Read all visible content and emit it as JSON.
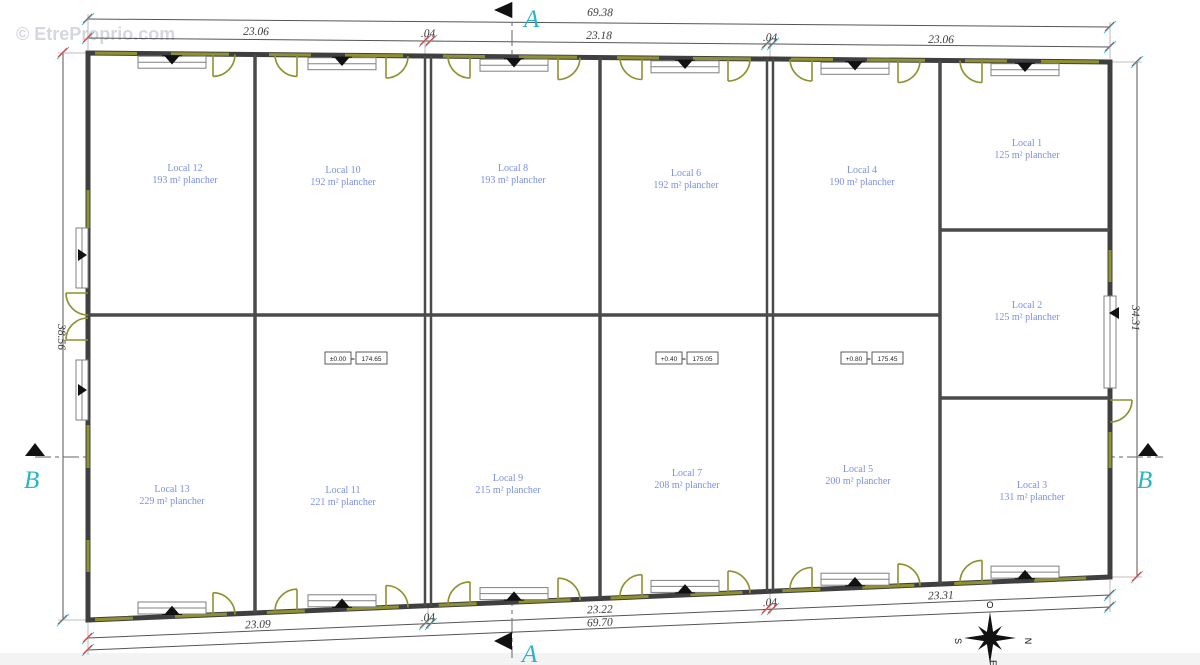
{
  "watermark": "© EtreProprio.com",
  "markers": {
    "a": "A",
    "b": "B"
  },
  "equals_sign": "=",
  "compass": {
    "n": "N",
    "s": "S",
    "e": "E",
    "o": "O"
  },
  "dimensions": {
    "top_total": "69.38",
    "top_seg1": "23.06",
    "top_gap1": ".04",
    "top_seg2": "23.18",
    "top_gap2": ".04",
    "top_seg3": "23.06",
    "bottom_total": "69.70",
    "bottom_seg1": "23.09",
    "bottom_gap1": ".04",
    "bottom_seg2": "23.22",
    "bottom_gap2": ".04",
    "bottom_seg3": "23.31",
    "left": "38.56",
    "right": "34.31"
  },
  "levels": [
    {
      "rel": "±0.00",
      "alt": "174.65"
    },
    {
      "rel": "+0.40",
      "alt": "175.05"
    },
    {
      "rel": "+0.80",
      "alt": "175.45"
    }
  ],
  "rooms": [
    {
      "name": "Local 1",
      "area": "125 m² plancher"
    },
    {
      "name": "Local 2",
      "area": "125 m² plancher"
    },
    {
      "name": "Local 3",
      "area": "131 m² plancher"
    },
    {
      "name": "Local 4",
      "area": "190 m² plancher"
    },
    {
      "name": "Local 5",
      "area": "200 m² plancher"
    },
    {
      "name": "Local 6",
      "area": "192 m² plancher"
    },
    {
      "name": "Local 7",
      "area": "208 m² plancher"
    },
    {
      "name": "Local 8",
      "area": "193 m² plancher"
    },
    {
      "name": "Local 9",
      "area": "215 m² plancher"
    },
    {
      "name": "Local 10",
      "area": "192 m² plancher"
    },
    {
      "name": "Local 11",
      "area": "221 m² plancher"
    },
    {
      "name": "Local 12",
      "area": "193 m² plancher"
    },
    {
      "name": "Local 13",
      "area": "229 m² plancher"
    }
  ],
  "colors": {
    "wall": "#3f3f3f",
    "door_olive": "#8f9130",
    "room_label": "#7c90dd",
    "section_marker": "#29b4c8",
    "tick_red": "#e03a3a",
    "tick_cyan": "#38c3d6"
  }
}
